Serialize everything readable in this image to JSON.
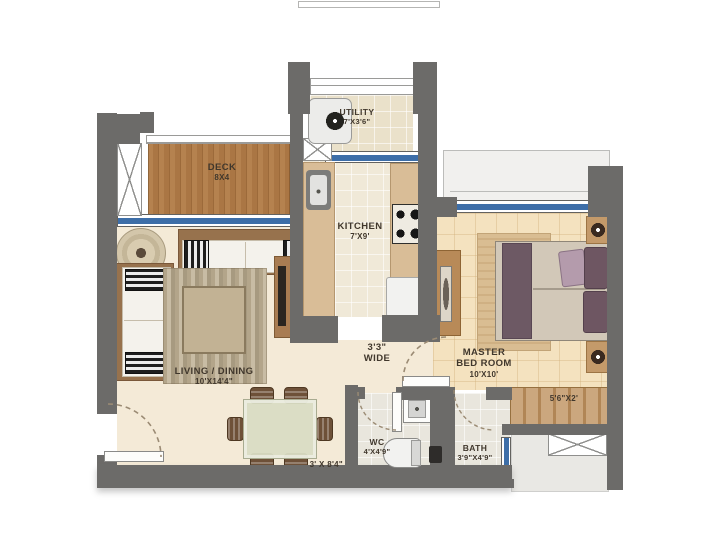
{
  "rooms": {
    "deck": {
      "name": "DECK",
      "dim": "8X4"
    },
    "utility": {
      "name": "UTILITY",
      "dim": "7'X3'6\""
    },
    "kitchen": {
      "name": "KITCHEN",
      "dim": "7'X9'"
    },
    "living": {
      "name": "LIVING / DINING",
      "dim": "10'X14'4\""
    },
    "master": {
      "line1": "MASTER",
      "line2": "BED ROOM",
      "dim": "10'X10'"
    },
    "passage": {
      "line1": "3'3\"",
      "line2": "WIDE"
    },
    "wc": {
      "name": "WC",
      "dim": "4'X4'9\""
    },
    "bath": {
      "name": "BATH",
      "dim": "3'9\"X4'9\""
    }
  },
  "dimensions": {
    "wardrobe": "5'6\"X2'",
    "dining": "3' X 8'4\""
  },
  "colors": {
    "wall": "#6c6b69",
    "window_blue": "#3d6ea8",
    "deck_wood": "#b07c4a",
    "floor_cream": "#f4ead7",
    "floor_tan": "#f4e2bf",
    "floor_kitchen_tile": "#f0e9d8",
    "floor_bath_tile": "#e9e6dd",
    "outdoor_gray": "#e9e8e4",
    "furniture_wood": "#bd9060",
    "label_text": "#40372c"
  }
}
